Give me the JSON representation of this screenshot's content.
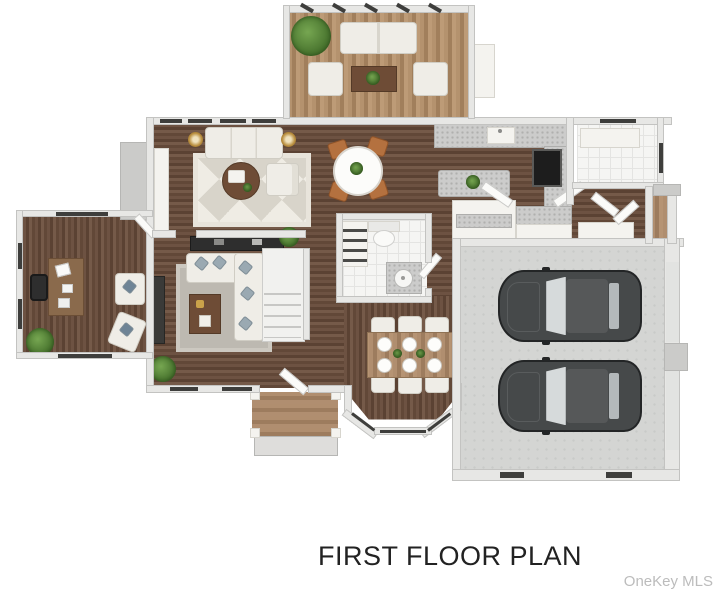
{
  "caption": {
    "title": "FIRST FLOOR PLAN"
  },
  "watermark": {
    "label": "OneKey MLS"
  },
  "plan": {
    "type": "3d-rendered-floor-plan",
    "rooms": [
      "sunroom",
      "living-room",
      "breakfast-nook",
      "kitchen",
      "pantry-laundry",
      "mudroom",
      "half-bathroom",
      "family-room",
      "staircase",
      "home-office",
      "hallway",
      "formal-dining-room",
      "entry-porch",
      "side-porch",
      "two-car-garage"
    ],
    "vehicle_count": 2,
    "dining_seat_count": 6
  },
  "colors": {
    "background": "#ffffff",
    "wall": "#e7e7e5",
    "wood_dark": "#63493a",
    "wood_deck": "#ac8a66",
    "garage_floor": "#d4d5d3",
    "tile": "#f5f5f3",
    "granite": "#cccccb",
    "car_body": "#46494a",
    "accent_chair": "#b4713f",
    "plant_green": "#5b8c3a",
    "caption_text": "#222222",
    "watermark_text": "#bcbcbc"
  }
}
